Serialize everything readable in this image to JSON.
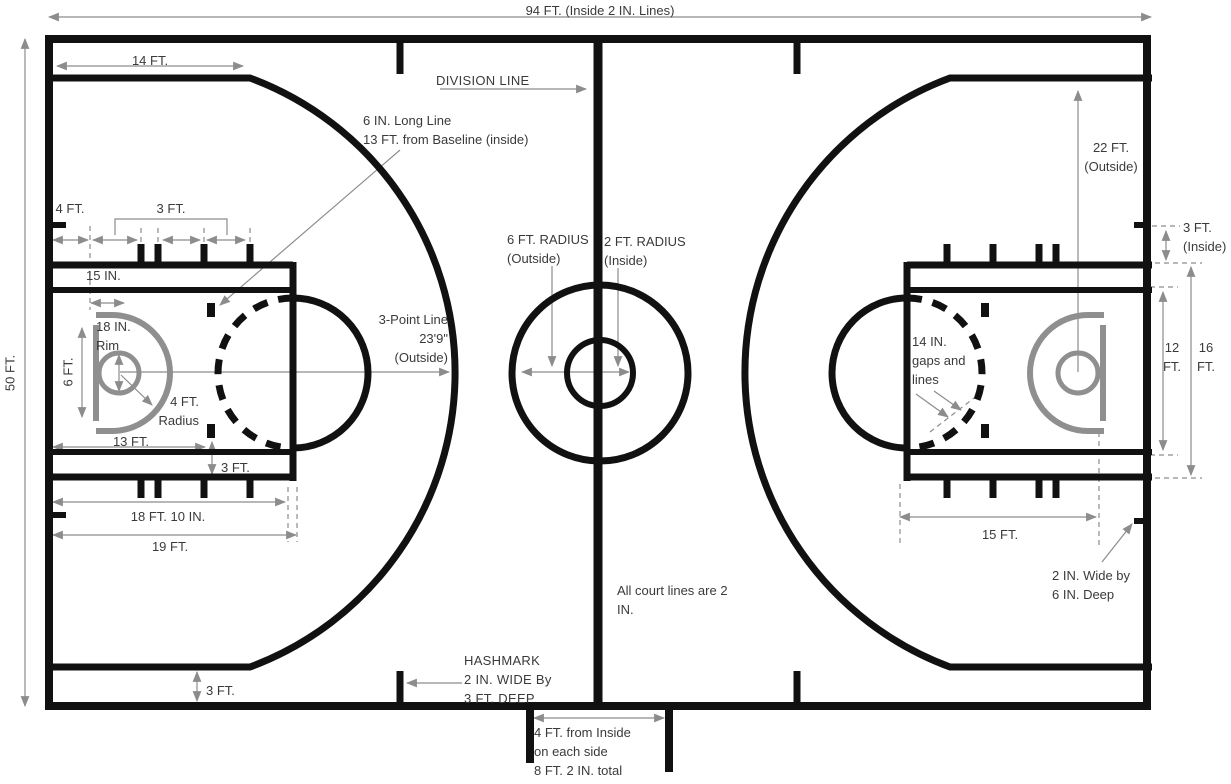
{
  "diagram": {
    "labels": {
      "court_length": "94 FT. (Inside 2 IN. Lines)",
      "court_width": "50 FT.",
      "fourteen_ft": "14 FT.",
      "division_line": "DIVISION LINE",
      "long_line_note": "6 IN. Long Line\n13 FT. from Baseline (inside)",
      "twenty_two_ft": "22 FT.\n(Outside)",
      "four_ft": "4 FT.",
      "three_ft_top": "3 FT.",
      "three_ft_inside": "3 FT.\n(Inside)",
      "fifteen_in": "15 IN.",
      "six_ft_radius": "6 FT. RADIUS\n(Outside)",
      "two_ft_radius": "2 FT. RADIUS\n(Inside)",
      "three_point_line": "3-Point Line\n23'9\"\n(Outside)",
      "eighteen_in_rim": "18 IN.\nRim",
      "six_ft": "6 FT.",
      "four_ft_radius": "4 FT.\nRadius",
      "fourteen_in_gaps": "14 IN.\ngaps and\nlines",
      "twelve_ft": "12\nFT.",
      "sixteen_ft": "16\nFT.",
      "thirteen_ft": "13 FT.",
      "three_ft_lane": "3 FT.",
      "eighteen_ft_ten": "18 FT. 10 IN.",
      "nineteen_ft": "19 FT.",
      "fifteen_ft": "15 FT.",
      "two_in_wide": "2 IN. Wide by\n6 IN. Deep",
      "all_lines_note": "All court lines are 2\nIN.",
      "hashmark_note": "HASHMARK\n2 IN. WIDE By\n3 FT. DEEP",
      "three_ft_hash": "3 FT.",
      "four_ft_total": "4 FT. from Inside\non each side\n8 FT. 2 IN. total"
    },
    "colors": {
      "court_line": "#111111",
      "equipment_gray": "#8f8f8f",
      "dimension_gray": "#8c8c8c",
      "text": "#3a3a3a",
      "background": "#ffffff"
    }
  }
}
